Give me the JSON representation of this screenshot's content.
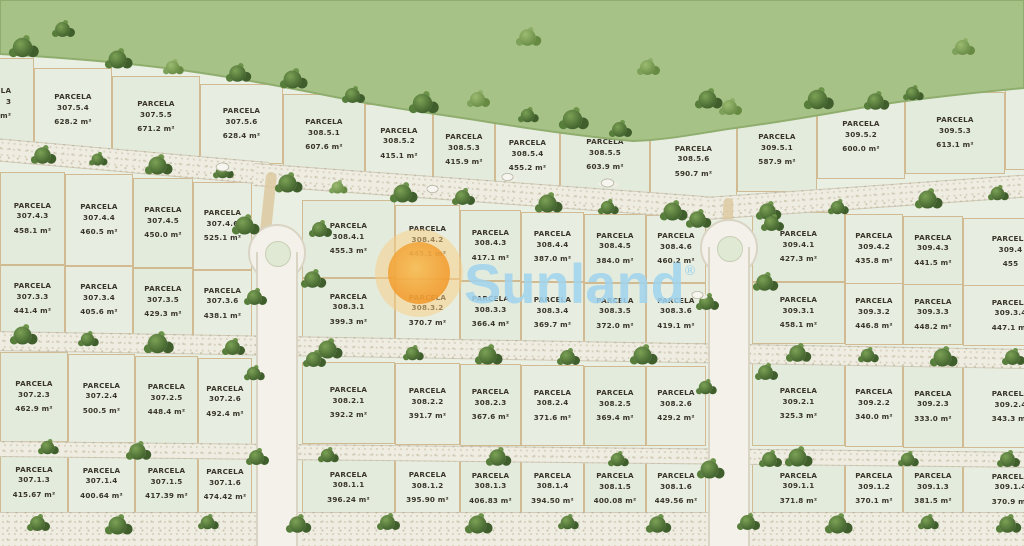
{
  "labels": {
    "parcela": "PARCELA"
  },
  "watermark": {
    "brand": "Sunland",
    "registered": "®"
  },
  "colors": {
    "parcel_fill": "#e3ebdd",
    "parcel_border": "#c19252",
    "greenbelt": "#a7c287",
    "tree_dark": "#44652f",
    "road": "#efede2",
    "watermark_text": "#a0d3ec",
    "watermark_sun": "#f29a2d"
  },
  "parcels": [
    {
      "id": "3",
      "area": "3.7 m²",
      "x": -46,
      "y": 58,
      "w": 80,
      "h": 92,
      "la": "r"
    },
    {
      "id": "307.5.4",
      "area": "628.2 m²",
      "x": 34,
      "y": 68,
      "w": 78,
      "h": 84
    },
    {
      "id": "307.5.5",
      "area": "671.2 m²",
      "x": 112,
      "y": 76,
      "w": 88,
      "h": 82
    },
    {
      "id": "307.5.6",
      "area": "628.4 m²",
      "x": 200,
      "y": 84,
      "w": 83,
      "h": 80
    },
    {
      "id": "308.5.1",
      "area": "607.6 m²",
      "x": 283,
      "y": 94,
      "w": 82,
      "h": 82
    },
    {
      "id": "308.5.2",
      "area": "415.1 m²",
      "x": 365,
      "y": 104,
      "w": 68,
      "h": 79
    },
    {
      "id": "308.5.3",
      "area": "415.9 m²",
      "x": 433,
      "y": 111,
      "w": 62,
      "h": 78
    },
    {
      "id": "308.5.4",
      "area": "455.2 m²",
      "x": 495,
      "y": 117,
      "w": 65,
      "h": 78
    },
    {
      "id": "308.5.5",
      "area": "603.9 m²",
      "x": 560,
      "y": 114,
      "w": 90,
      "h": 82
    },
    {
      "id": "308.5.6",
      "area": "590.7 m²",
      "x": 650,
      "y": 120,
      "w": 87,
      "h": 83
    },
    {
      "id": "309.5.1",
      "area": "587.9 m²",
      "x": 737,
      "y": 108,
      "w": 80,
      "h": 84
    },
    {
      "id": "309.5.2",
      "area": "600.0 m²",
      "x": 817,
      "y": 95,
      "w": 88,
      "h": 84
    },
    {
      "id": "309.5.3",
      "area": "613.1 m²",
      "x": 905,
      "y": 92,
      "w": 100,
      "h": 82
    },
    {
      "id": "",
      "area": "",
      "x": 1005,
      "y": 88,
      "w": 60,
      "h": 82
    },
    {
      "id": "307.4.3",
      "area": "458.1 m²",
      "x": 0,
      "y": 172,
      "w": 65,
      "h": 93
    },
    {
      "id": "307.4.4",
      "area": "460.5 m²",
      "x": 65,
      "y": 174,
      "w": 68,
      "h": 92
    },
    {
      "id": "307.4.5",
      "area": "450.0 m²",
      "x": 133,
      "y": 178,
      "w": 60,
      "h": 90
    },
    {
      "id": "307.4.6",
      "area": "525.1 m²",
      "x": 193,
      "y": 182,
      "w": 59,
      "h": 88
    },
    {
      "id": "308.4.1",
      "area": "455.3 m²",
      "x": 302,
      "y": 200,
      "w": 93,
      "h": 78
    },
    {
      "id": "308.4.2",
      "area": "445.1 m²",
      "x": 395,
      "y": 205,
      "w": 65,
      "h": 74
    },
    {
      "id": "308.4.3",
      "area": "417.1 m²",
      "x": 460,
      "y": 210,
      "w": 61,
      "h": 71
    },
    {
      "id": "308.4.4",
      "area": "387.0 m²",
      "x": 521,
      "y": 212,
      "w": 63,
      "h": 70
    },
    {
      "id": "308.4.5",
      "area": "384.0 m²",
      "x": 584,
      "y": 214,
      "w": 62,
      "h": 69
    },
    {
      "id": "308.4.6",
      "area": "460.2 m²",
      "x": 646,
      "y": 215,
      "w": 60,
      "h": 68
    },
    {
      "id": "309.4.1",
      "area": "427.3 m²",
      "x": 752,
      "y": 212,
      "w": 93,
      "h": 70
    },
    {
      "id": "309.4.2",
      "area": "435.8 m²",
      "x": 845,
      "y": 214,
      "w": 58,
      "h": 70
    },
    {
      "id": "309.4.3",
      "area": "441.5 m²",
      "x": 903,
      "y": 216,
      "w": 60,
      "h": 69
    },
    {
      "id": "309.4",
      "area": "455",
      "x": 963,
      "y": 218,
      "w": 95,
      "h": 68
    },
    {
      "id": "307.3.3",
      "area": "441.4 m²",
      "x": 0,
      "y": 265,
      "w": 65,
      "h": 68
    },
    {
      "id": "307.3.4",
      "area": "405.6 m²",
      "x": 65,
      "y": 266,
      "w": 68,
      "h": 68
    },
    {
      "id": "307.3.5",
      "area": "429.3 m²",
      "x": 133,
      "y": 268,
      "w": 60,
      "h": 68
    },
    {
      "id": "307.3.6",
      "area": "438.1 m²",
      "x": 193,
      "y": 270,
      "w": 59,
      "h": 67
    },
    {
      "id": "308.3.1",
      "area": "399.3 m²",
      "x": 302,
      "y": 278,
      "w": 93,
      "h": 63
    },
    {
      "id": "308.3.2",
      "area": "370.7 m²",
      "x": 395,
      "y": 279,
      "w": 65,
      "h": 63
    },
    {
      "id": "308.3.3",
      "area": "366.4 m²",
      "x": 460,
      "y": 281,
      "w": 61,
      "h": 62
    },
    {
      "id": "308.3.4",
      "area": "369.7 m²",
      "x": 521,
      "y": 282,
      "w": 63,
      "h": 62
    },
    {
      "id": "308.3.5",
      "area": "372.0 m²",
      "x": 584,
      "y": 283,
      "w": 62,
      "h": 61
    },
    {
      "id": "308.3.6",
      "area": "419.1 m²",
      "x": 646,
      "y": 283,
      "w": 60,
      "h": 61
    },
    {
      "id": "309.3.1",
      "area": "458.1 m²",
      "x": 752,
      "y": 282,
      "w": 93,
      "h": 62
    },
    {
      "id": "309.3.2",
      "area": "446.8 m²",
      "x": 845,
      "y": 283,
      "w": 58,
      "h": 62
    },
    {
      "id": "309.3.3",
      "area": "448.2 m²",
      "x": 903,
      "y": 284,
      "w": 60,
      "h": 61
    },
    {
      "id": "309.3.4",
      "area": "447.1 m²",
      "x": 963,
      "y": 285,
      "w": 95,
      "h": 61
    },
    {
      "id": "307.2.3",
      "area": "462.9 m²",
      "x": 0,
      "y": 352,
      "w": 68,
      "h": 90
    },
    {
      "id": "307.2.4",
      "area": "500.5 m²",
      "x": 68,
      "y": 354,
      "w": 67,
      "h": 89
    },
    {
      "id": "307.2.5",
      "area": "448.4 m²",
      "x": 135,
      "y": 356,
      "w": 63,
      "h": 88
    },
    {
      "id": "307.2.6",
      "area": "492.4 m²",
      "x": 198,
      "y": 358,
      "w": 54,
      "h": 87
    },
    {
      "id": "308.2.1",
      "area": "392.2 m²",
      "x": 302,
      "y": 362,
      "w": 93,
      "h": 82
    },
    {
      "id": "308.2.2",
      "area": "391.7 m²",
      "x": 395,
      "y": 363,
      "w": 65,
      "h": 82
    },
    {
      "id": "308.2.3",
      "area": "367.6 m²",
      "x": 460,
      "y": 364,
      "w": 61,
      "h": 82
    },
    {
      "id": "308.2.4",
      "area": "371.6 m²",
      "x": 521,
      "y": 365,
      "w": 63,
      "h": 81
    },
    {
      "id": "308.2.5",
      "area": "369.4 m²",
      "x": 584,
      "y": 366,
      "w": 62,
      "h": 80
    },
    {
      "id": "308.2.6",
      "area": "429.2 m²",
      "x": 646,
      "y": 366,
      "w": 60,
      "h": 80
    },
    {
      "id": "309.2.1",
      "area": "325.3 m²",
      "x": 752,
      "y": 362,
      "w": 93,
      "h": 84
    },
    {
      "id": "309.2.2",
      "area": "340.0 m²",
      "x": 845,
      "y": 363,
      "w": 58,
      "h": 84
    },
    {
      "id": "309.2.3",
      "area": "333.0 m²",
      "x": 903,
      "y": 365,
      "w": 60,
      "h": 83
    },
    {
      "id": "309.2.4",
      "area": "343.3 m²",
      "x": 963,
      "y": 366,
      "w": 95,
      "h": 82
    },
    {
      "id": "307.1.3",
      "area": "415.67 m²",
      "x": 0,
      "y": 450,
      "w": 68,
      "h": 65
    },
    {
      "id": "307.1.4",
      "area": "400.64 m²",
      "x": 68,
      "y": 452,
      "w": 67,
      "h": 63
    },
    {
      "id": "307.1.5",
      "area": "417.39 m²",
      "x": 135,
      "y": 453,
      "w": 63,
      "h": 62
    },
    {
      "id": "307.1.6",
      "area": "474.42 m²",
      "x": 198,
      "y": 455,
      "w": 54,
      "h": 60
    },
    {
      "id": "308.1.1",
      "area": "396.24 m²",
      "x": 302,
      "y": 459,
      "w": 93,
      "h": 57
    },
    {
      "id": "308.1.2",
      "area": "395.90 m²",
      "x": 395,
      "y": 460,
      "w": 65,
      "h": 56
    },
    {
      "id": "308.1.3",
      "area": "406.83 m²",
      "x": 460,
      "y": 461,
      "w": 61,
      "h": 55
    },
    {
      "id": "308.1.4",
      "area": "394.50 m²",
      "x": 521,
      "y": 461,
      "w": 63,
      "h": 55
    },
    {
      "id": "308.1.5",
      "area": "400.08 m²",
      "x": 584,
      "y": 462,
      "w": 62,
      "h": 54
    },
    {
      "id": "308.1.6",
      "area": "449.56 m²",
      "x": 646,
      "y": 462,
      "w": 60,
      "h": 54
    },
    {
      "id": "309.1.1",
      "area": "371.8 m²",
      "x": 752,
      "y": 461,
      "w": 93,
      "h": 55
    },
    {
      "id": "309.1.2",
      "area": "370.1 m²",
      "x": 845,
      "y": 462,
      "w": 58,
      "h": 54
    },
    {
      "id": "309.1.3",
      "area": "381.5 m²",
      "x": 903,
      "y": 462,
      "w": 60,
      "h": 54
    },
    {
      "id": "309.1.4",
      "area": "370.9 m²",
      "x": 963,
      "y": 463,
      "w": 95,
      "h": 53
    }
  ]
}
